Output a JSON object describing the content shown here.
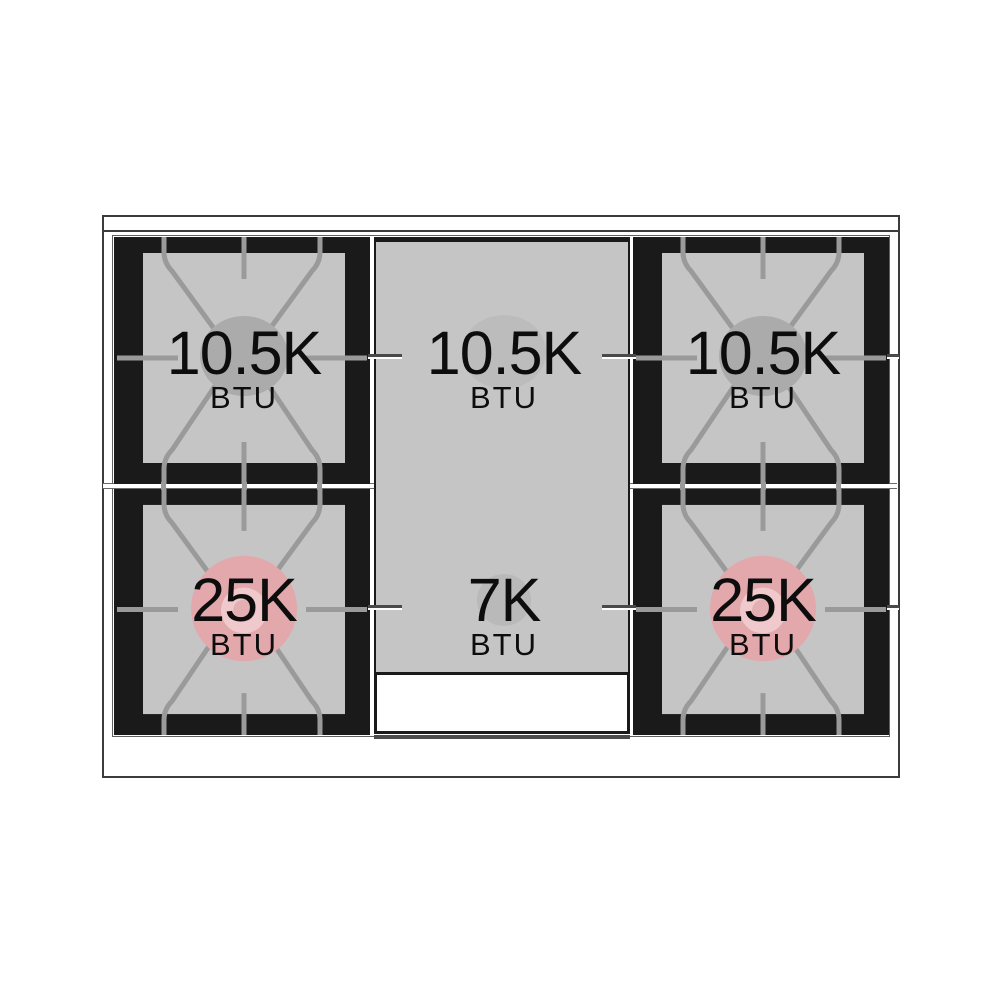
{
  "diagram": {
    "unit_label": "BTU",
    "burners": {
      "top_left": {
        "value": "10.5K",
        "unit": "BTU"
      },
      "top_center": {
        "value": "10.5K",
        "unit": "BTU"
      },
      "top_right": {
        "value": "10.5K",
        "unit": "BTU"
      },
      "bottom_left": {
        "value": "25K",
        "unit": "BTU"
      },
      "bottom_center": {
        "value": "7K",
        "unit": "BTU"
      },
      "bottom_right": {
        "value": "25K",
        "unit": "BTU"
      }
    },
    "colors": {
      "surface_gray": "#c5c5c5",
      "frame_black": "#1a1a1a",
      "grate_line": "#9a9a9a",
      "standard_burner_gray": "#ababab",
      "high_output_burner_pink": "#e3a8ac",
      "outline_dark": "#3c3c3c"
    }
  }
}
